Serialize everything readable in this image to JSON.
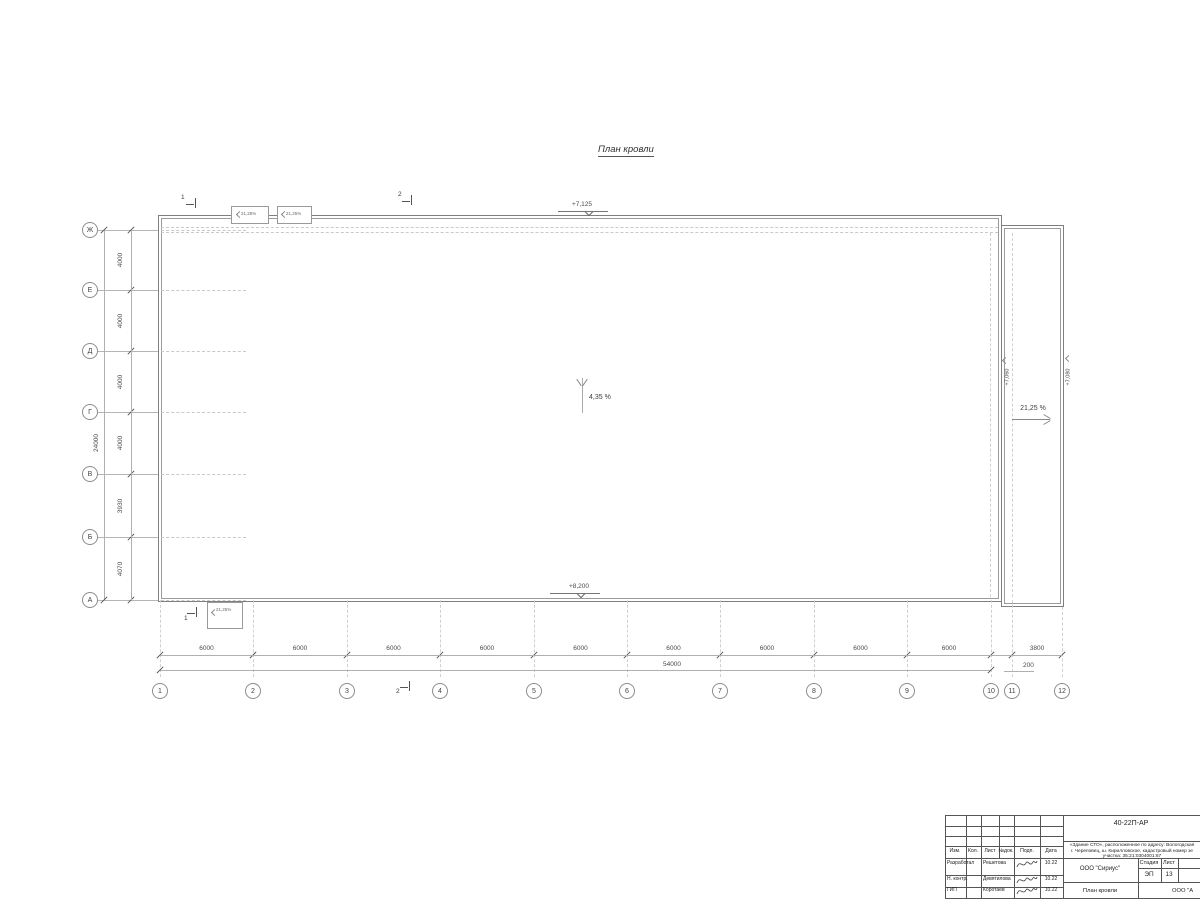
{
  "drawing": {
    "title": "План кровли",
    "elev_top": "+7,125",
    "elev_bottom": "+8,200",
    "elev_right_inner": "+7,060",
    "elev_right_outer": "+7,080",
    "main_slope": "4,35 %",
    "right_slope": "21,25 %",
    "canopy_slope": "21,25%",
    "section_1": "1",
    "section_2": "2"
  },
  "axes": {
    "row_labels": [
      "Ж",
      "Е",
      "Д",
      "Г",
      "В",
      "Б",
      "А"
    ],
    "row_dims": [
      "4000",
      "4000",
      "4000",
      "4000",
      "3930",
      "4070"
    ],
    "row_total": "24000",
    "col_labels": [
      "1",
      "2",
      "3",
      "4",
      "5",
      "6",
      "7",
      "8",
      "9",
      "10",
      "11",
      "12"
    ],
    "col_dims": [
      "6000",
      "6000",
      "6000",
      "6000",
      "6000",
      "6000",
      "6000",
      "6000",
      "6000",
      "200",
      "3800"
    ],
    "col_total": "54000"
  },
  "titleblock": {
    "doc_number": "40-22П-АР",
    "project_lines": [
      "«Здание СТО», расположенное по адресу: Вологодская",
      "г. Череповец, ш. Кирилловское, кадастровый номер зе",
      "участка: 35:21:0304001:67"
    ],
    "header_cols": [
      "Изм.",
      "Кол.",
      "Лист",
      "№док.",
      "Подп.",
      "Дата"
    ],
    "sign_rows": [
      {
        "role": "Разработал",
        "name": "Решетова",
        "date": "10.22"
      },
      {
        "role": "Н. контр.",
        "name": "Девятилова",
        "date": "10.22"
      },
      {
        "role": "ГИП",
        "name": "Коротаев",
        "date": "10.22"
      }
    ],
    "company": "ООО \"Сириус\"",
    "stage_label": "Стадия",
    "sheet_label": "Лист",
    "stage_value": "ЭП",
    "sheet_value": "13",
    "sheet_title": "План кровли",
    "org_name": "ООО \"А"
  }
}
